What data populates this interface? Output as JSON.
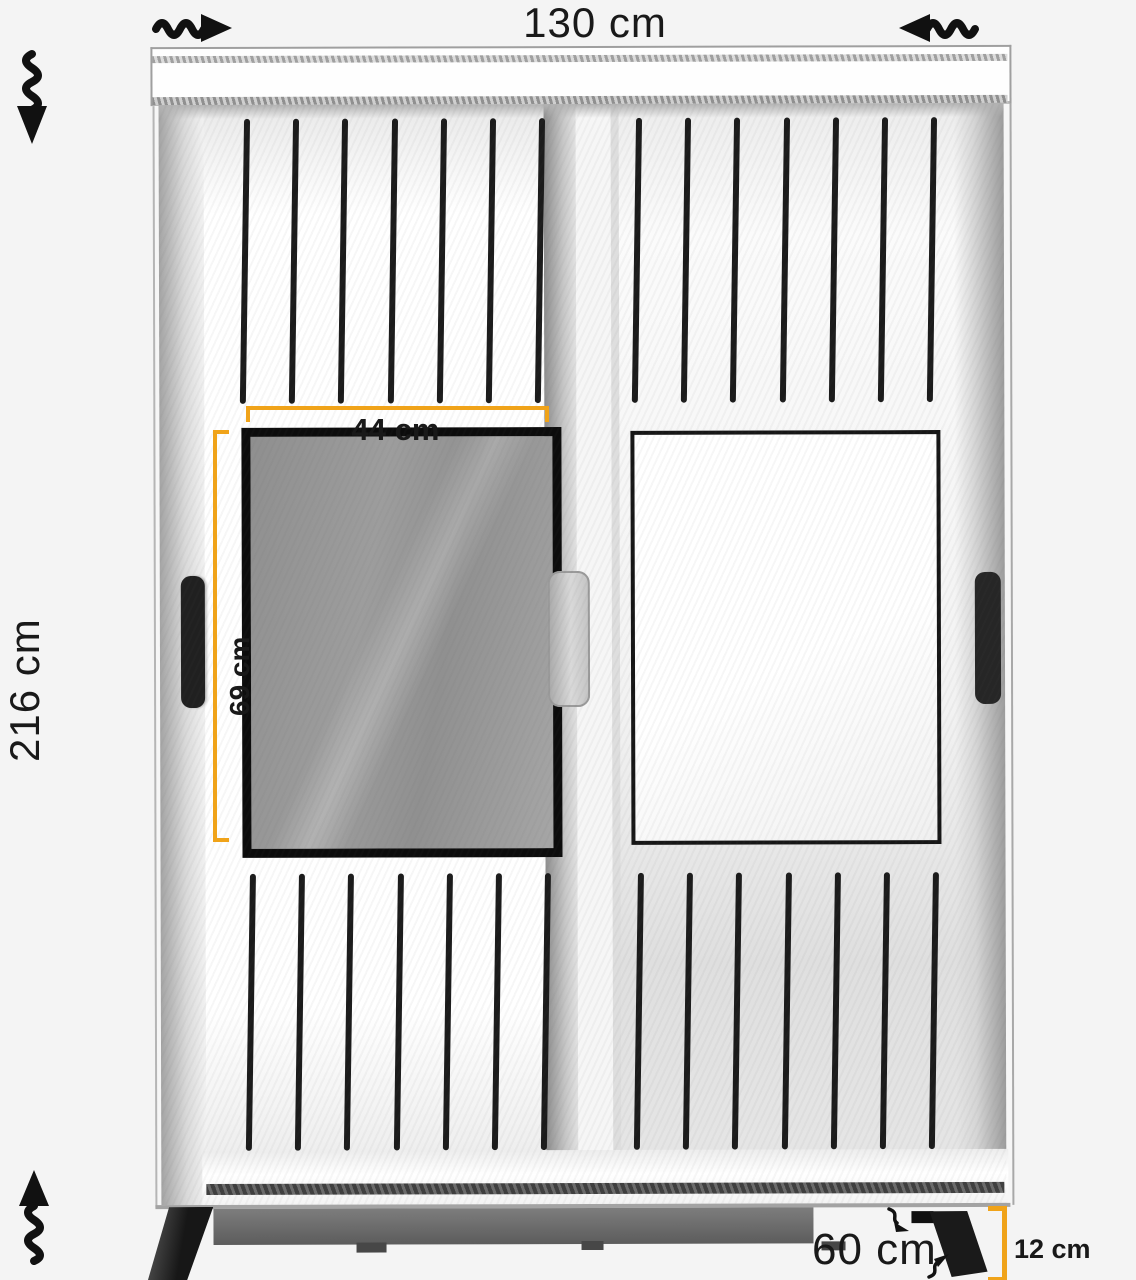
{
  "figure": {
    "name": "sliding-wardrobe-dimension-diagram",
    "labels": {
      "width": "130 cm",
      "height": "216 cm",
      "mirror_width": "44 cm",
      "mirror_height": "69 cm",
      "depth": "60 cm",
      "legs": "12 cm"
    },
    "colors": {
      "dimension_accent": "#f0a319",
      "line_black": "#191919",
      "slat": "#1b1b1b",
      "mirror_glass": "#9b9b9b",
      "plinth": "#5c5c5c",
      "background": "#f4f4f4"
    },
    "icons": {
      "top_left": "wavy-arrow-right-icon",
      "top_right": "wavy-arrow-left-icon",
      "upper_left": "wavy-arrow-down-icon",
      "lower_left": "wavy-arrow-up-icon",
      "depth_upper": "small-wavy-arrow-icon",
      "depth_lower": "small-wavy-arrow-icon"
    }
  }
}
